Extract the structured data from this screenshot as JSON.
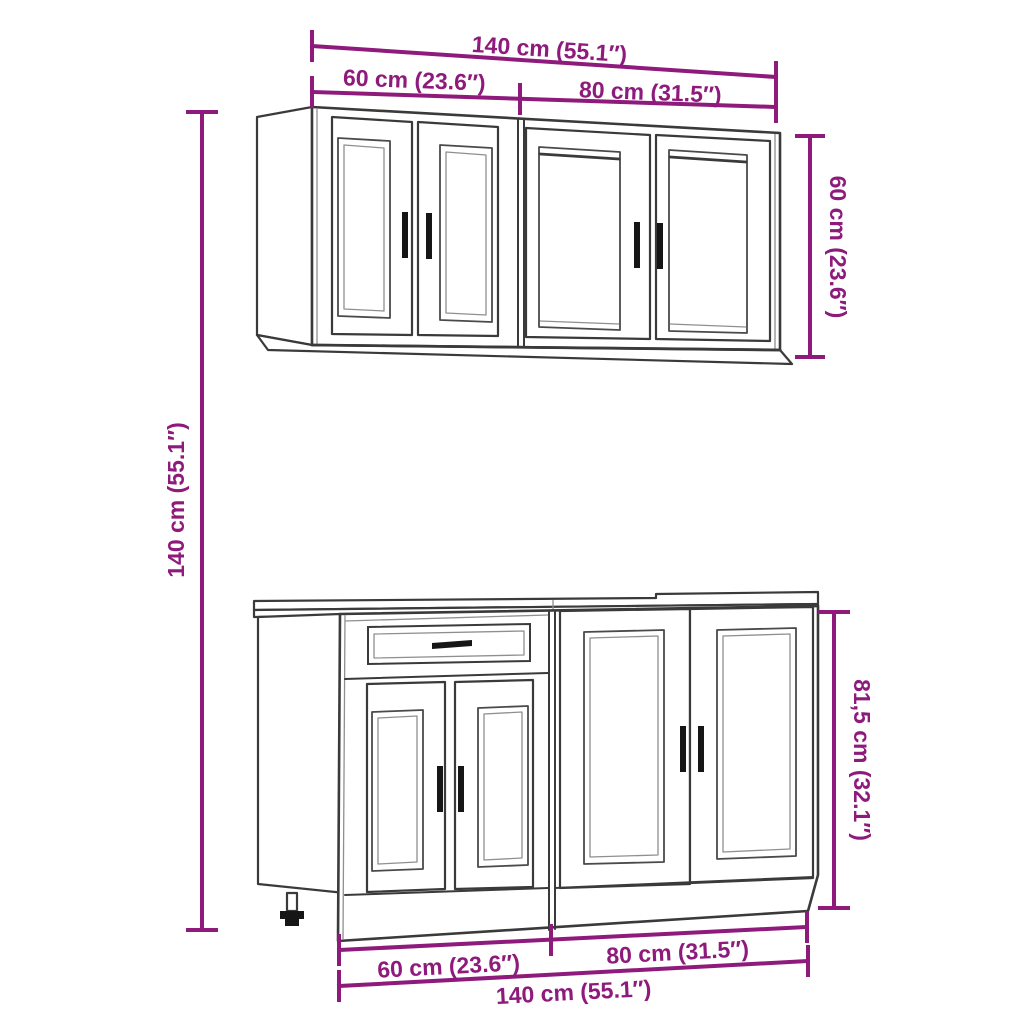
{
  "diagram": {
    "colors": {
      "dimension_accent": "#8E1A7C",
      "outline": "#3A3A3A",
      "background": "#FFFFFF"
    },
    "labels": {
      "top_total_width": "140 cm (55.1″)",
      "top_wall_left_width": "60 cm (23.6″)",
      "top_wall_right_width": "80 cm (31.5″)",
      "wall_cabinet_height": "60 cm (23.6″)",
      "overall_height": "140 cm (55.1″)",
      "base_cabinet_height": "81,5 cm (32.1″)",
      "bottom_base_left_width": "60 cm (23.6″)",
      "bottom_base_right_width": "80 cm (31.5″)",
      "bottom_total_width": "140 cm (55.1″)"
    }
  }
}
